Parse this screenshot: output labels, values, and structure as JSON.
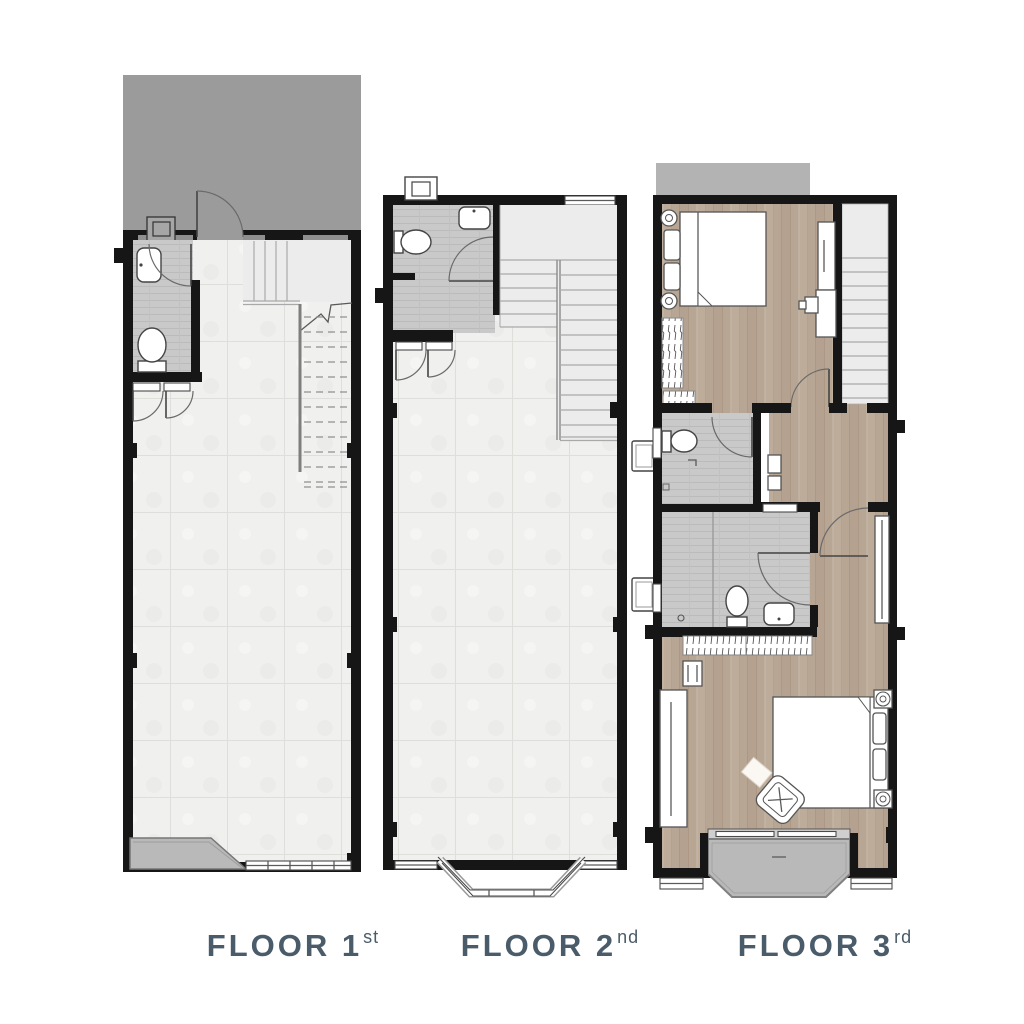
{
  "title": "Townhouse floor plans",
  "floors": [
    {
      "name": "FLOOR",
      "number": "1",
      "ordinal": "st"
    },
    {
      "name": "FLOOR",
      "number": "2",
      "ordinal": "nd"
    },
    {
      "name": "FLOOR",
      "number": "3",
      "ordinal": "rd"
    }
  ],
  "colors": {
    "label_text": "#4a5b69",
    "wall": "#161616",
    "carport_gray": "#9b9b9b",
    "roof_gray": "#b3b3b3",
    "balcony_gray": "#b9b9b9",
    "tile_floor": "#f0f0ee",
    "bathroom_tile": "#c9c9c9",
    "wood_floor": "#b8a695",
    "stair_fill": "#ececec",
    "background": "#ffffff"
  }
}
